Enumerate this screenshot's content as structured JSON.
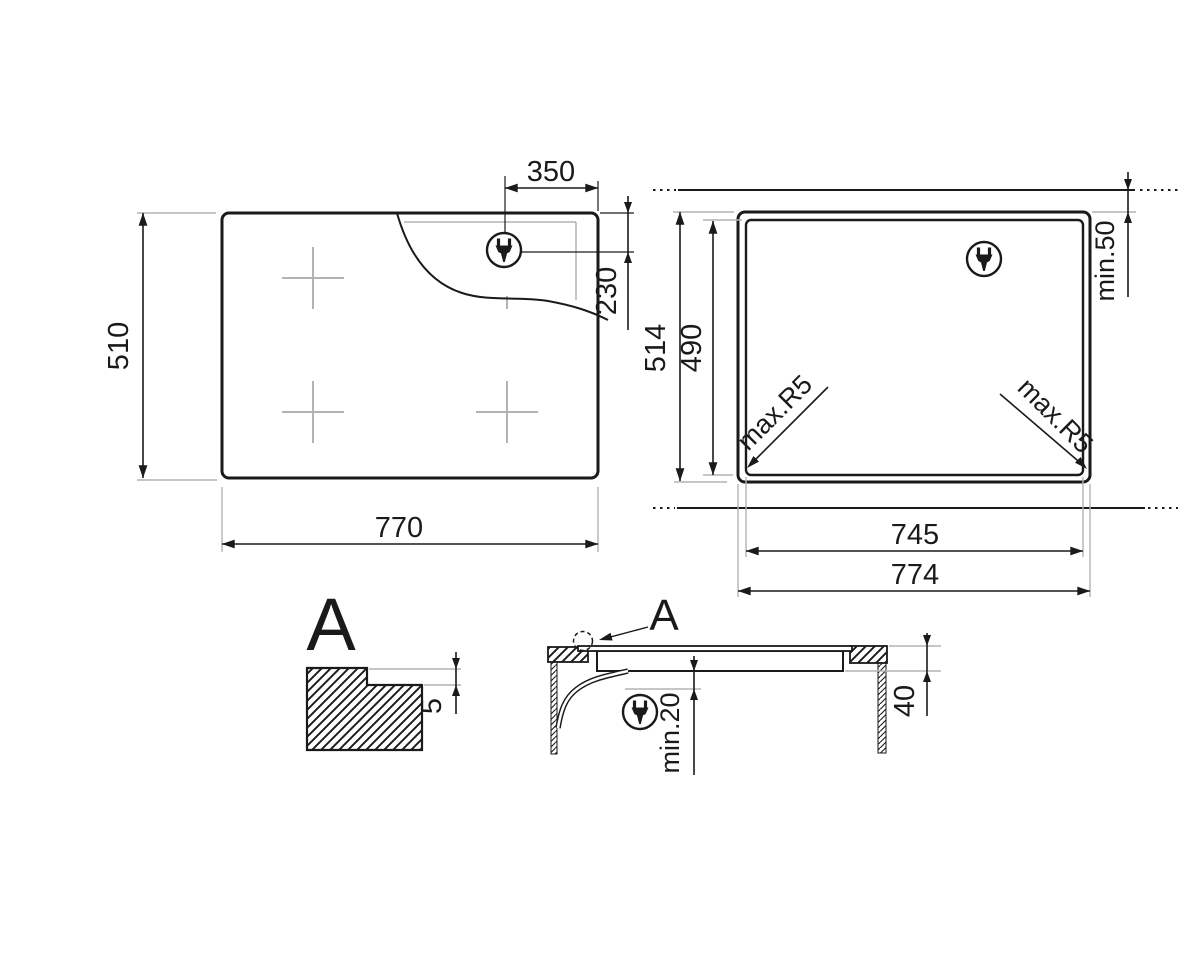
{
  "drawing_title": "Hob installation dimension drawing",
  "colors": {
    "line": "#1a1a1a",
    "aux_gray": "#b3b3b3",
    "background": "#ffffff"
  },
  "top_view": {
    "width": "770",
    "height": "510",
    "plug_offset_from_right_edge": "350",
    "plug_offset_from_top_edge": "230",
    "plug_icon": "power-plug-icon",
    "burner_marks": 4
  },
  "cutout_view": {
    "outer_width": "774",
    "outer_height": "514",
    "cutout_width": "745",
    "cutout_height": "490",
    "min_wall_distance": "min.50",
    "corner_radius_left": "max.R5",
    "corner_radius_right": "max.R5",
    "plug_icon": "power-plug-icon"
  },
  "detail_view": {
    "label": "A",
    "step_depth": "5"
  },
  "section_view": {
    "detail_ref": "A",
    "min_clearance_below": "min.20",
    "body_depth": "40",
    "plug_icon": "power-plug-icon"
  }
}
